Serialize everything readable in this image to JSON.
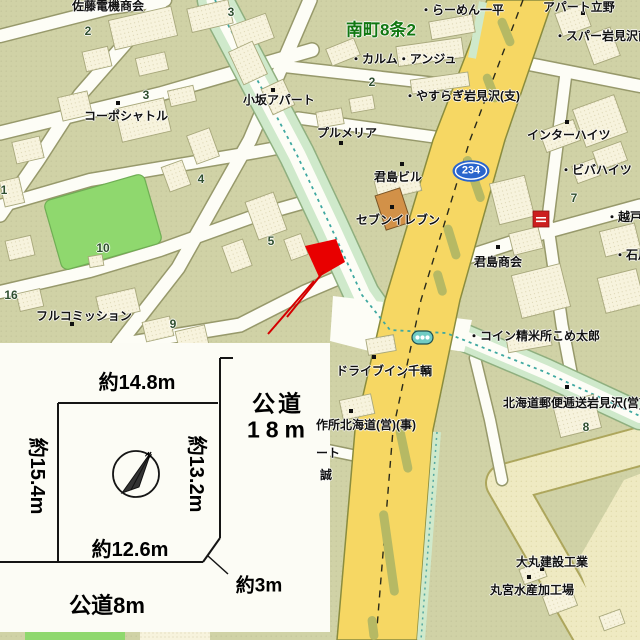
{
  "map": {
    "district_label": "南町8条2",
    "route_shield": {
      "number": "234"
    },
    "colors": {
      "land": "#d0d2a6",
      "street": "#ffffff",
      "building": "#f7f3dd",
      "main_road_yellow": "#f6d763",
      "median_olive": "#b6b964",
      "tree_strip_green": "#cfe9cb",
      "park_green": "#8fd86e",
      "pale_road": "#f2ebbe",
      "route_blue": "#2a65cc",
      "marker_red": "#e80000",
      "district_green": "#117711",
      "boundary_teal": "#3fa8a0",
      "seven_eleven_orange": "#d29148"
    },
    "labels": [
      {
        "name": "label-sato-denki",
        "text": "佐藤電機商会",
        "x": 72,
        "y": 6,
        "size": 12,
        "anchor": "l"
      },
      {
        "name": "label-minamimachi-8jo2",
        "text": "南町8条2",
        "x": 346,
        "y": 30,
        "size": 17,
        "anchor": "l",
        "color": "#117711"
      },
      {
        "name": "label-ramen-ippei",
        "text": "・らーめん一平",
        "x": 420,
        "y": 10,
        "size": 12,
        "anchor": "l"
      },
      {
        "name": "label-apart-tateno",
        "text": "アパート立野",
        "x": 543,
        "y": 7,
        "size": 12,
        "anchor": "l"
      },
      {
        "name": "label-spar-iwamizawa",
        "text": "・スパー岩見沢南",
        "x": 554,
        "y": 36,
        "size": 12,
        "anchor": "l"
      },
      {
        "name": "label-calme-ange",
        "text": "・カルム・アンジュ",
        "x": 350,
        "y": 59,
        "size": 12,
        "anchor": "l"
      },
      {
        "name": "label-yasuragi",
        "text": "・やすらぎ岩見沢(支)",
        "x": 404,
        "y": 96,
        "size": 12,
        "anchor": "l"
      },
      {
        "name": "label-plumeria",
        "text": "プルメリア",
        "x": 317,
        "y": 133,
        "size": 12,
        "anchor": "l"
      },
      {
        "name": "label-inter-heights",
        "text": "インターハイツ",
        "x": 527,
        "y": 135,
        "size": 12,
        "anchor": "l"
      },
      {
        "name": "label-viva-heights",
        "text": "・ビバハイツ",
        "x": 560,
        "y": 170,
        "size": 12,
        "anchor": "l"
      },
      {
        "name": "label-kimishima-building",
        "text": "君島ビル",
        "x": 374,
        "y": 177,
        "size": 12,
        "anchor": "l"
      },
      {
        "name": "label-seven-eleven",
        "text": "セブンイレブン",
        "x": 356,
        "y": 220,
        "size": 12,
        "anchor": "l"
      },
      {
        "name": "label-kimishima-shokai",
        "text": "君島商会",
        "x": 474,
        "y": 262,
        "size": 12,
        "anchor": "l"
      },
      {
        "name": "label-koshido",
        "text": "・越戸工",
        "x": 606,
        "y": 217,
        "size": 12,
        "anchor": "l"
      },
      {
        "name": "label-ishikawa",
        "text": "・石川",
        "x": 614,
        "y": 255,
        "size": 12,
        "anchor": "l"
      },
      {
        "name": "label-corpo-shuttle",
        "text": "コーポシャトル",
        "x": 84,
        "y": 116,
        "size": 12,
        "anchor": "l"
      },
      {
        "name": "label-kosaka-apart",
        "text": "小坂アパート",
        "x": 243,
        "y": 100,
        "size": 12,
        "anchor": "l"
      },
      {
        "name": "label-full-commission",
        "text": "フルコミッション",
        "x": 36,
        "y": 316,
        "size": 12,
        "anchor": "l"
      },
      {
        "name": "label-coin-rice-mill",
        "text": "・コイン精米所こめ太郎",
        "x": 468,
        "y": 336,
        "size": 12,
        "anchor": "l"
      },
      {
        "name": "label-drive-in",
        "text": "ドライブイン千輌",
        "x": 336,
        "y": 371,
        "size": 12,
        "anchor": "l"
      },
      {
        "name": "label-sakusho-hokkaido",
        "text": "作所北海道(営)(事)",
        "x": 316,
        "y": 425,
        "size": 12,
        "anchor": "l"
      },
      {
        "name": "label-postal-transport",
        "text": "北海道郵便逓送岩見沢(営)",
        "x": 503,
        "y": 403,
        "size": 12,
        "anchor": "l"
      },
      {
        "name": "label-truncated-to",
        "text": "ート",
        "x": 316,
        "y": 453,
        "size": 12,
        "anchor": "l"
      },
      {
        "name": "label-truncated-makoto",
        "text": "誠",
        "x": 320,
        "y": 475,
        "size": 12,
        "anchor": "l"
      },
      {
        "name": "label-daimaru-kensetsu",
        "text": "大丸建設工業",
        "x": 516,
        "y": 562,
        "size": 12,
        "anchor": "l"
      },
      {
        "name": "label-marumiya-suisan",
        "text": "丸宮水産加工場",
        "x": 490,
        "y": 590,
        "size": 12,
        "anchor": "l"
      },
      {
        "name": "block-number",
        "text": "2",
        "x": 88,
        "y": 31,
        "size": 12,
        "anchor": "c",
        "color": "#2f4f2f"
      },
      {
        "name": "block-number",
        "text": "3",
        "x": 231,
        "y": 12,
        "size": 12,
        "anchor": "c",
        "color": "#2f4f2f"
      },
      {
        "name": "block-number",
        "text": "3",
        "x": 146,
        "y": 95,
        "size": 12,
        "anchor": "c",
        "color": "#2f4f2f"
      },
      {
        "name": "block-number",
        "text": "2",
        "x": 372,
        "y": 82,
        "size": 12,
        "anchor": "c",
        "color": "#2f4f2f"
      },
      {
        "name": "block-number",
        "text": "4",
        "x": 201,
        "y": 179,
        "size": 12,
        "anchor": "c",
        "color": "#2f4f2f"
      },
      {
        "name": "block-number",
        "text": "5",
        "x": 271,
        "y": 241,
        "size": 12,
        "anchor": "c",
        "color": "#2f4f2f"
      },
      {
        "name": "block-number",
        "text": "9",
        "x": 173,
        "y": 324,
        "size": 12,
        "anchor": "c",
        "color": "#2f4f2f"
      },
      {
        "name": "block-number",
        "text": "16",
        "x": 11,
        "y": 295,
        "size": 12,
        "anchor": "c",
        "color": "#2f4f2f"
      },
      {
        "name": "block-number",
        "text": "10",
        "x": 103,
        "y": 248,
        "size": 12,
        "anchor": "c",
        "color": "#2f4f2f"
      },
      {
        "name": "block-number",
        "text": "1",
        "x": 4,
        "y": 190,
        "size": 12,
        "anchor": "c",
        "color": "#2f4f2f"
      },
      {
        "name": "block-number",
        "text": "7",
        "x": 574,
        "y": 198,
        "size": 12,
        "anchor": "c",
        "color": "#2f4f2f"
      },
      {
        "name": "block-number",
        "text": "8",
        "x": 586,
        "y": 427,
        "size": 12,
        "anchor": "c",
        "color": "#2f4f2f"
      },
      {
        "name": "route-shield-number",
        "text": "234",
        "x": 471,
        "y": 171,
        "size": 11,
        "anchor": "c",
        "color": "#ffffff",
        "halo": false
      },
      {
        "name": "inset-dim-top",
        "text": "約14.8m",
        "x": 137,
        "y": 383,
        "size": 20,
        "anchor": "c",
        "inset": true
      },
      {
        "name": "inset-road-east-line1",
        "text": "公道",
        "x": 278,
        "y": 404,
        "size": 23,
        "anchor": "c",
        "inset": true,
        "ls": 3
      },
      {
        "name": "inset-road-east-line2",
        "text": "18m",
        "x": 279,
        "y": 430,
        "size": 23,
        "anchor": "c",
        "inset": true,
        "ls": 6
      },
      {
        "name": "inset-dim-left",
        "text": "約15.4m",
        "x": 37,
        "y": 476,
        "size": 20,
        "anchor": "c",
        "rot": 90,
        "inset": true
      },
      {
        "name": "inset-dim-right",
        "text": "約13.2m",
        "x": 196,
        "y": 474,
        "size": 20,
        "anchor": "c",
        "rot": 90,
        "inset": true
      },
      {
        "name": "inset-dim-bottom",
        "text": "約12.6m",
        "x": 130,
        "y": 550,
        "size": 20,
        "anchor": "c",
        "inset": true
      },
      {
        "name": "inset-dim-corner",
        "text": "約3m",
        "x": 259,
        "y": 586,
        "size": 19,
        "anchor": "c",
        "inset": true
      },
      {
        "name": "inset-road-south",
        "text": "公道8m",
        "x": 107,
        "y": 606,
        "size": 22,
        "anchor": "c",
        "inset": true
      },
      {
        "name": "inset-compass-n",
        "text": "N",
        "x": 148,
        "y": 456,
        "size": 8,
        "anchor": "c",
        "rot": 40,
        "inset": true
      }
    ],
    "pois": [
      [
        273,
        90
      ],
      [
        118,
        103
      ],
      [
        341,
        143
      ],
      [
        402,
        164
      ],
      [
        392,
        207
      ],
      [
        567,
        122
      ],
      [
        583,
        13
      ],
      [
        498,
        247
      ],
      [
        72,
        324
      ],
      [
        374,
        357
      ],
      [
        351,
        411
      ],
      [
        567,
        387
      ],
      [
        542,
        569
      ],
      [
        529,
        577
      ]
    ]
  },
  "inset": {
    "lot_dimensions": {
      "top": "約14.8m",
      "left": "約15.4m",
      "right": "約13.2m",
      "bottom": "約12.6m",
      "corner_cut": "約3m"
    },
    "roads": {
      "east": "公道 18m",
      "south": "公道8m"
    },
    "compass": "N"
  }
}
